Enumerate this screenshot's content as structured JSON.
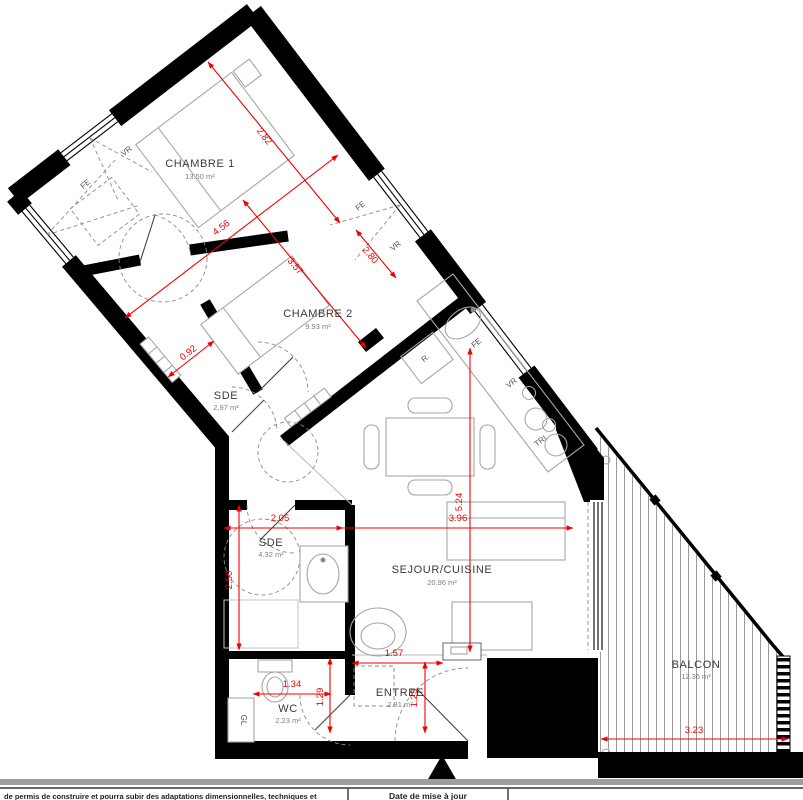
{
  "plan": {
    "rooms": {
      "chambre1": {
        "name": "CHAMBRE 1",
        "area": "13.50 m²"
      },
      "chambre2": {
        "name": "CHAMBRE 2",
        "area": "9.93 m²"
      },
      "sde1": {
        "name": "SDE",
        "area": "2.97 m²"
      },
      "sde2": {
        "name": "SDE",
        "area": "4.32 m²"
      },
      "sejour": {
        "name": "SEJOUR/CUISINE",
        "area": "20.96 m²"
      },
      "wc": {
        "name": "WC",
        "area": "2.23 m²"
      },
      "entree": {
        "name": "ENTREE",
        "area": "2.81 m²"
      },
      "balcon": {
        "name": "BALCON",
        "area": "12.36 m²"
      }
    },
    "dimensions": {
      "chambre1_width": "2.82",
      "chambre1_length": "4.56",
      "chambre2_length": "3.57",
      "sde1_width": "0.92",
      "chambre2_window": "2.80",
      "sde2_width": "2.05",
      "sde2_height": "2.50",
      "sejour_width": "3.96",
      "sejour_height": "5.24",
      "entree_top": "1.57",
      "wc_width": "1.34",
      "hall_height": "1.29",
      "entree_height": "1.23",
      "balcon_width": "3.23"
    },
    "tags": {
      "fe": "FE",
      "vr": "VR",
      "fridge": "R.",
      "tri": "TRI",
      "gl": "GL"
    }
  },
  "footer": {
    "note": "de permis de construire et pourra subir des adaptations dimensionnelles, techniques et",
    "date_label": "Date de mise à jour"
  },
  "colors": {
    "wall": "#000000",
    "dimension": "#FF0000",
    "furniture": "#A6A6A6"
  }
}
